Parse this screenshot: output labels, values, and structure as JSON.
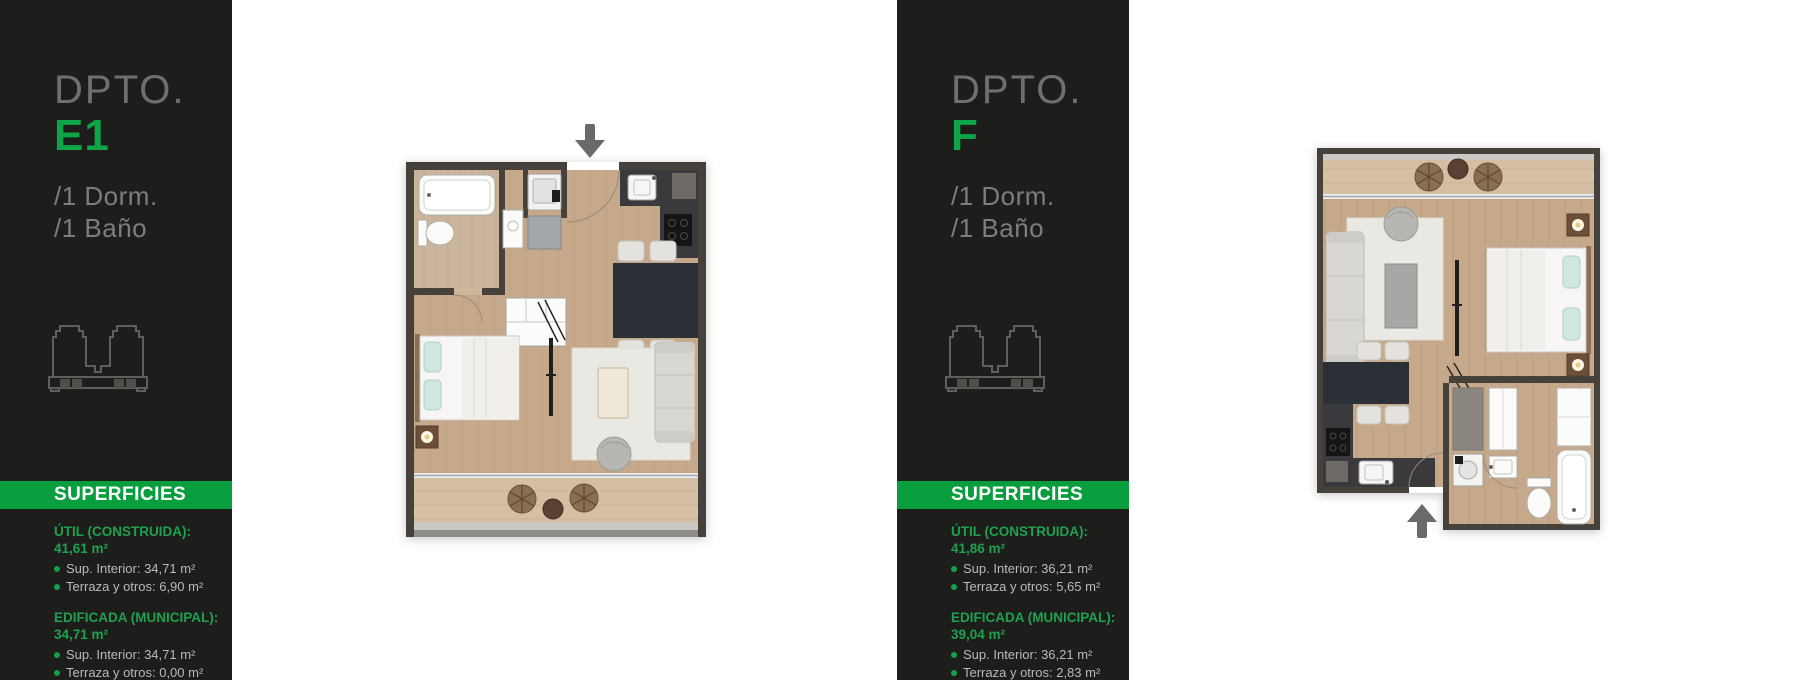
{
  "colors": {
    "accent_green": "#0ea548",
    "banner_green": "#089e3e",
    "panel_background": "#1d1d1b"
  },
  "units": [
    {
      "dpto_label": "DPTO.",
      "code": "E1",
      "features": [
        "/1 Dorm.",
        "/1 Baño"
      ],
      "superficies_title": "SUPERFICIES",
      "sections": [
        {
          "label": "ÚTIL (CONSTRUIDA):",
          "value": "41,61 m²",
          "items": [
            {
              "label": "Sup. Interior:",
              "value": "34,71 m²"
            },
            {
              "label": "Terraza y otros:",
              "value": "6,90 m²"
            }
          ]
        },
        {
          "label": "EDIFICADA (MUNICIPAL):",
          "value": "34,71 m²",
          "items": [
            {
              "label": "Sup. Interior:",
              "value": "34,71 m²"
            },
            {
              "label": "Terraza y otros:",
              "value": "0,00 m²"
            }
          ]
        }
      ]
    },
    {
      "dpto_label": "DPTO.",
      "code": "F",
      "features": [
        "/1 Dorm.",
        "/1 Baño"
      ],
      "superficies_title": "SUPERFICIES",
      "sections": [
        {
          "label": "ÚTIL (CONSTRUIDA):",
          "value": "41,86 m²",
          "items": [
            {
              "label": "Sup. Interior:",
              "value": "36,21 m²"
            },
            {
              "label": "Terraza y otros:",
              "value": "5,65 m²"
            }
          ]
        },
        {
          "label": "EDIFICADA (MUNICIPAL):",
          "value": "39,04 m²",
          "items": [
            {
              "label": "Sup. Interior:",
              "value": "36,21 m²"
            },
            {
              "label": "Terraza y otros:",
              "value": "2,83 m²"
            }
          ]
        }
      ]
    }
  ],
  "floor_plans": [
    {
      "unit": "E1",
      "entrance_arrow": "down"
    },
    {
      "unit": "F",
      "entrance_arrow": "up"
    }
  ]
}
